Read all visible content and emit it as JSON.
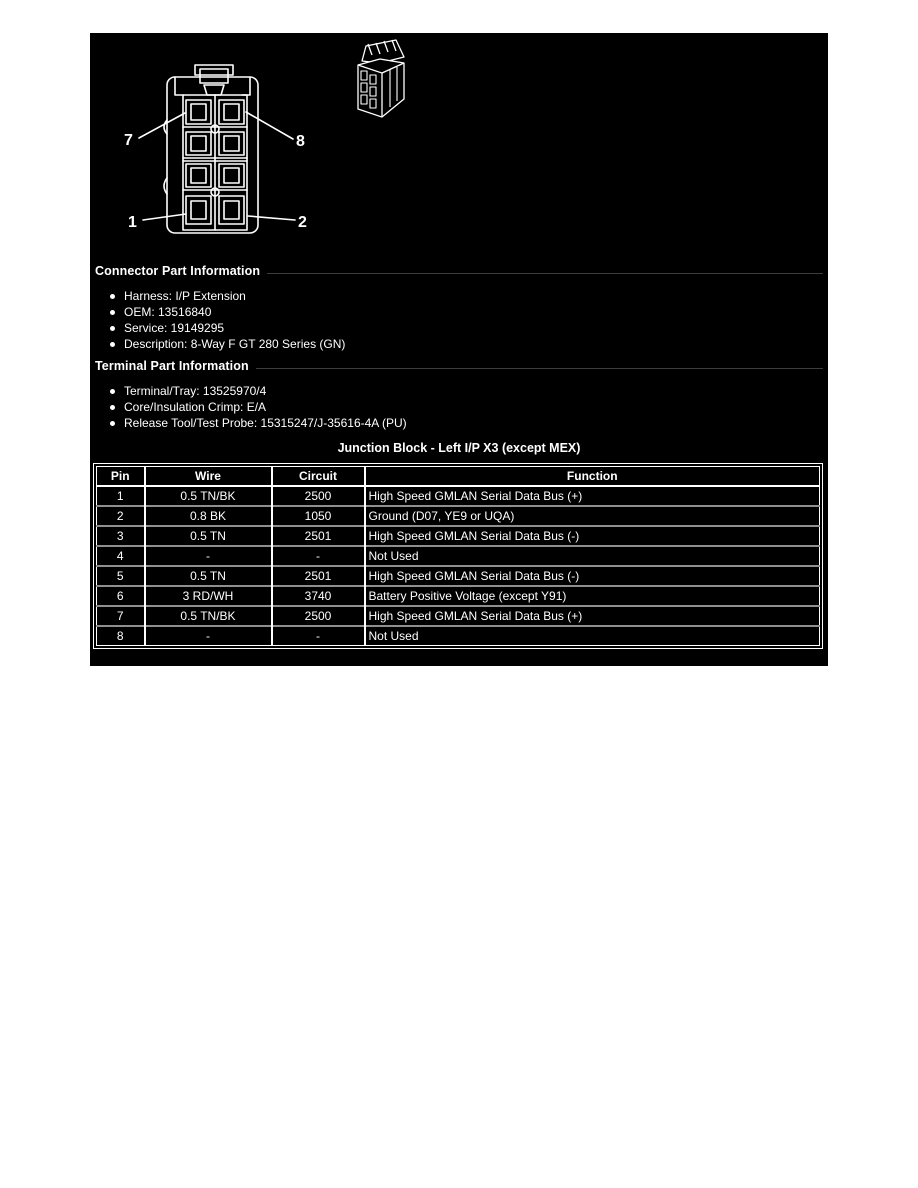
{
  "figure": {
    "callouts": [
      "7",
      "8",
      "1",
      "2"
    ]
  },
  "connector_part": {
    "heading": "Connector Part Information",
    "items": [
      "Harness: I/P Extension",
      "OEM: 13516840",
      "Service: 19149295",
      "Description: 8-Way F GT 280 Series (GN)"
    ]
  },
  "terminal_part": {
    "heading": "Terminal Part Information",
    "items": [
      "Terminal/Tray: 13525970/4",
      "Core/Insulation Crimp: E/A",
      "Release Tool/Test Probe: 15315247/J-35616-4A (PU)"
    ]
  },
  "pin_table": {
    "title": "Junction Block - Left I/P X3 (except MEX)",
    "columns": [
      "Pin",
      "Wire",
      "Circuit",
      "Function"
    ],
    "rows": [
      [
        "1",
        "0.5 TN/BK",
        "2500",
        "High Speed GMLAN Serial Data Bus (+)"
      ],
      [
        "2",
        "0.8 BK",
        "1050",
        "Ground (D07, YE9 or UQA)"
      ],
      [
        "3",
        "0.5 TN",
        "2501",
        "High Speed GMLAN Serial Data Bus (-)"
      ],
      [
        "4",
        "-",
        "-",
        "Not Used"
      ],
      [
        "5",
        "0.5 TN",
        "2501",
        "High Speed GMLAN Serial Data Bus (-)"
      ],
      [
        "6",
        "3 RD/WH",
        "3740",
        "Battery Positive Voltage (except Y91)"
      ],
      [
        "7",
        "0.5 TN/BK",
        "2500",
        "High Speed GMLAN Serial Data Bus (+)"
      ],
      [
        "8",
        "-",
        "-",
        "Not Used"
      ]
    ]
  },
  "colors": {
    "panel_bg": "#000000",
    "text": "#ffffff",
    "line": "#ffffff",
    "row_divider": "#8f8f8f"
  }
}
